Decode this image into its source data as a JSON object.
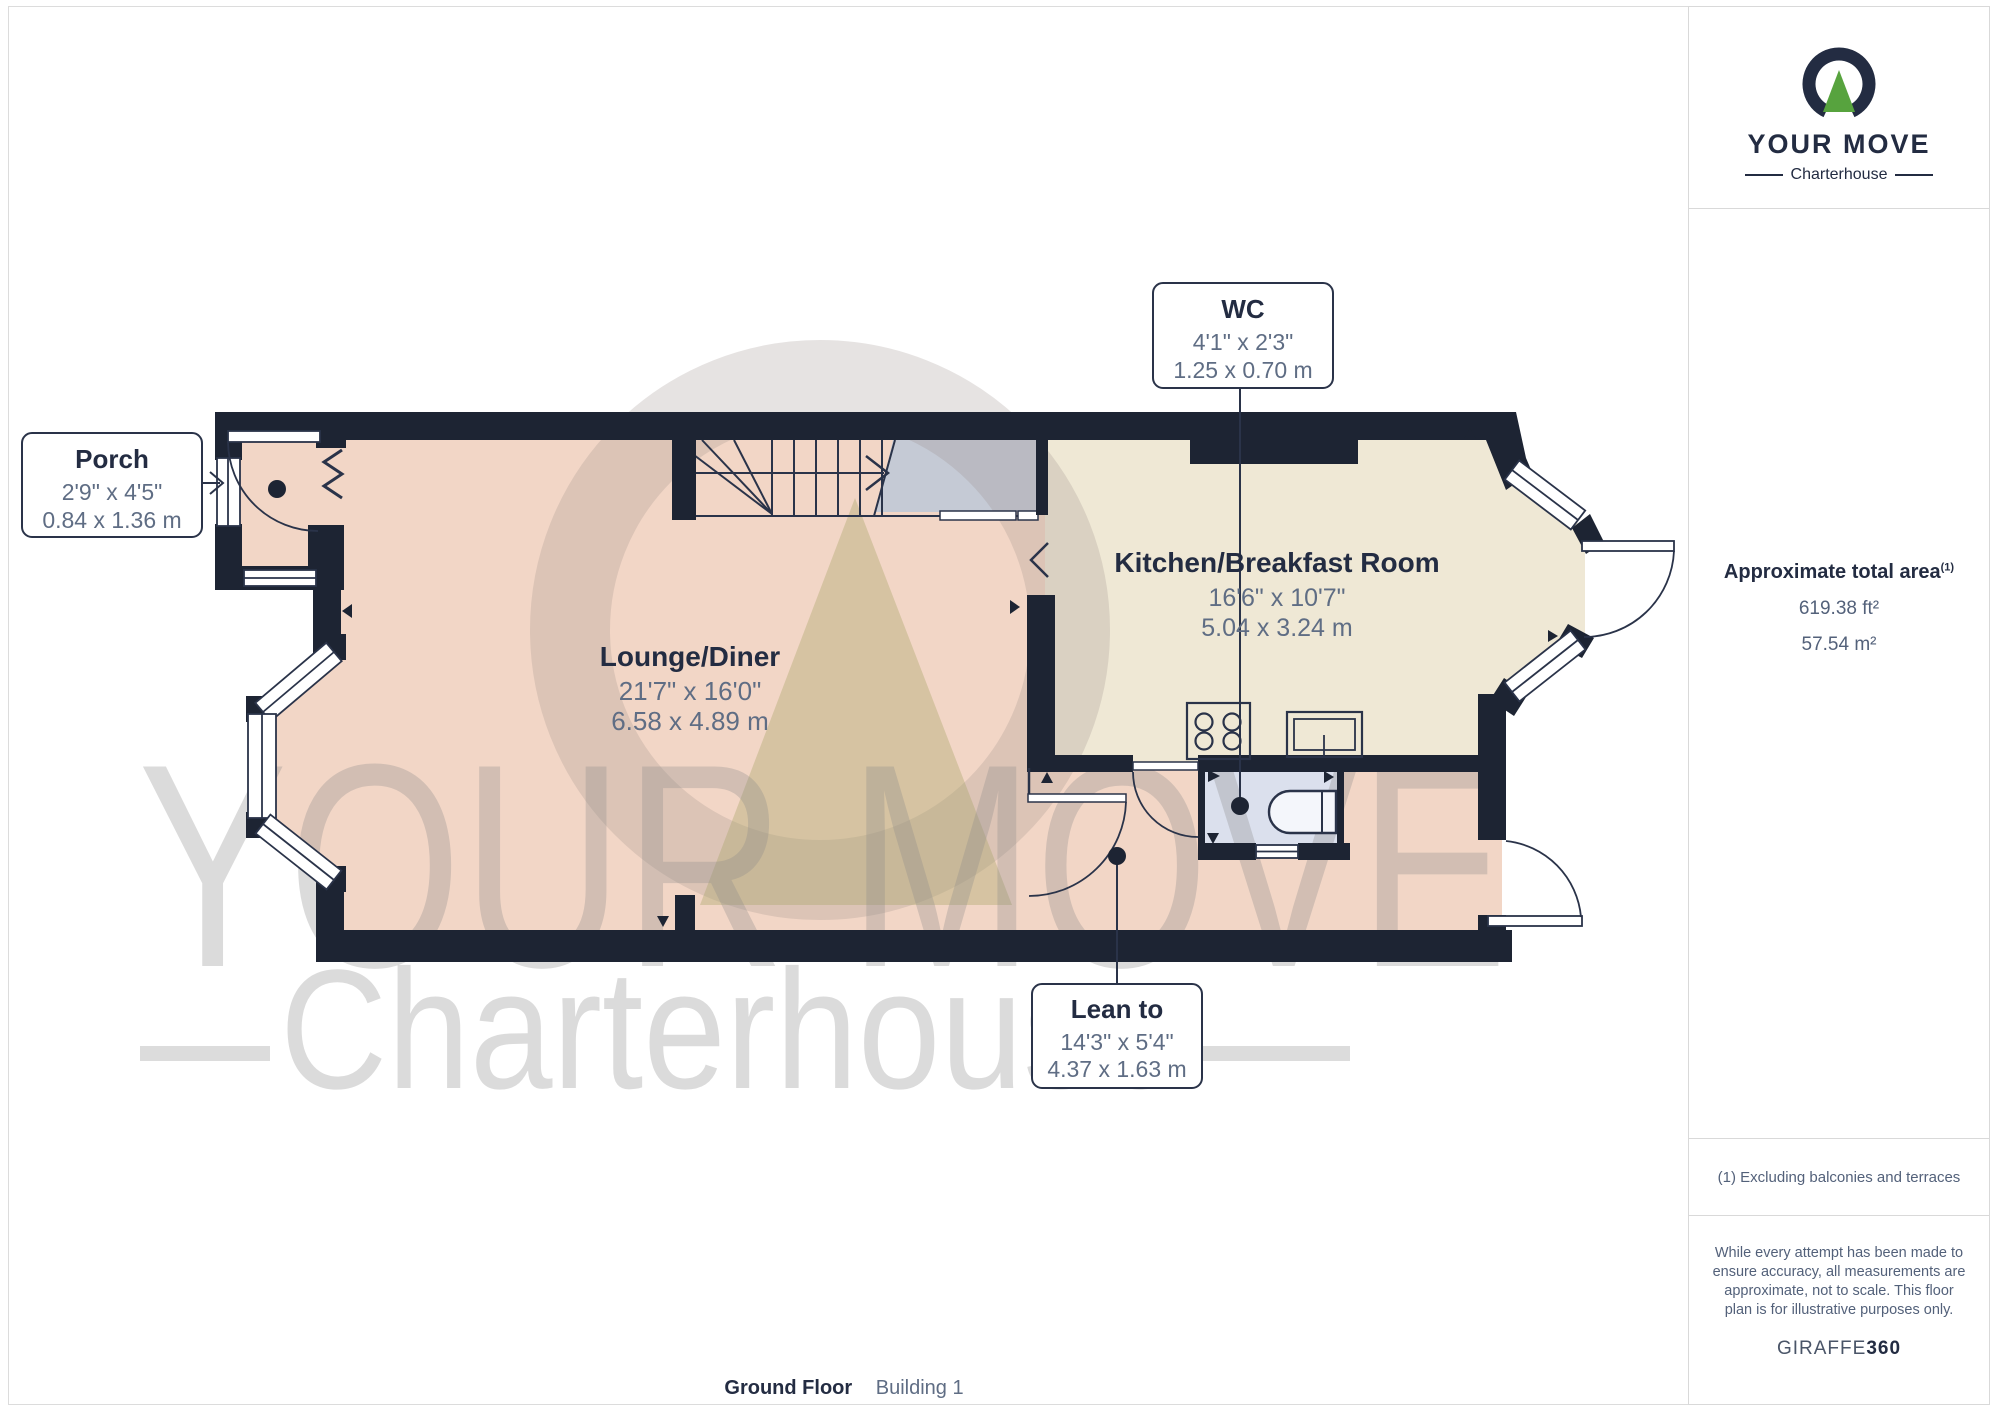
{
  "branding": {
    "name": "YOUR MOVE",
    "sub": "Charterhouse"
  },
  "sidebar": {
    "area_title": "Approximate total area",
    "area_sup": "(1)",
    "area_ft": "619.38 ft²",
    "area_m": "57.54 m²",
    "footnote": "(1) Excluding balconies and terraces",
    "disclaimer": "While every attempt has been made to ensure accuracy, all measurements are approximate, not to scale. This floor plan is for illustrative purposes only.",
    "credit_a": "GIRAFFE",
    "credit_b": "360"
  },
  "caption": {
    "floor": "Ground Floor",
    "building": "Building 1"
  },
  "watermark": {
    "line1": "YOUR MOVE",
    "line2": "Charterhouse"
  },
  "plan": {
    "rooms": {
      "lounge": {
        "name": "Lounge/Diner",
        "imperial": "21'7\" x 16'0\"",
        "metric": "6.58 x 4.89 m"
      },
      "kitchen": {
        "name": "Kitchen/Breakfast Room",
        "imperial": "16'6\" x 10'7\"",
        "metric": "5.04 x 3.24 m"
      },
      "porch": {
        "name": "Porch",
        "imperial": "2'9\" x 4'5\"",
        "metric": "0.84 x 1.36 m"
      },
      "wc": {
        "name": "WC",
        "imperial": "4'1\" x 2'3\"",
        "metric": "1.25 x 0.70 m"
      },
      "leanto": {
        "name": "Lean to",
        "imperial": "14'3\" x 5'4\"",
        "metric": "4.37 x 1.63 m"
      }
    },
    "colors": {
      "wall": "#1d2433",
      "lounge_floor": "#f2d6c6",
      "kitchen_floor": "#efe8d5",
      "wc_floor": "#dbe0ed",
      "landing_gray": "#c5cad5",
      "accent_green": "#57a33e",
      "navy": "#232c42",
      "dim_text": "#5f6d84"
    }
  }
}
